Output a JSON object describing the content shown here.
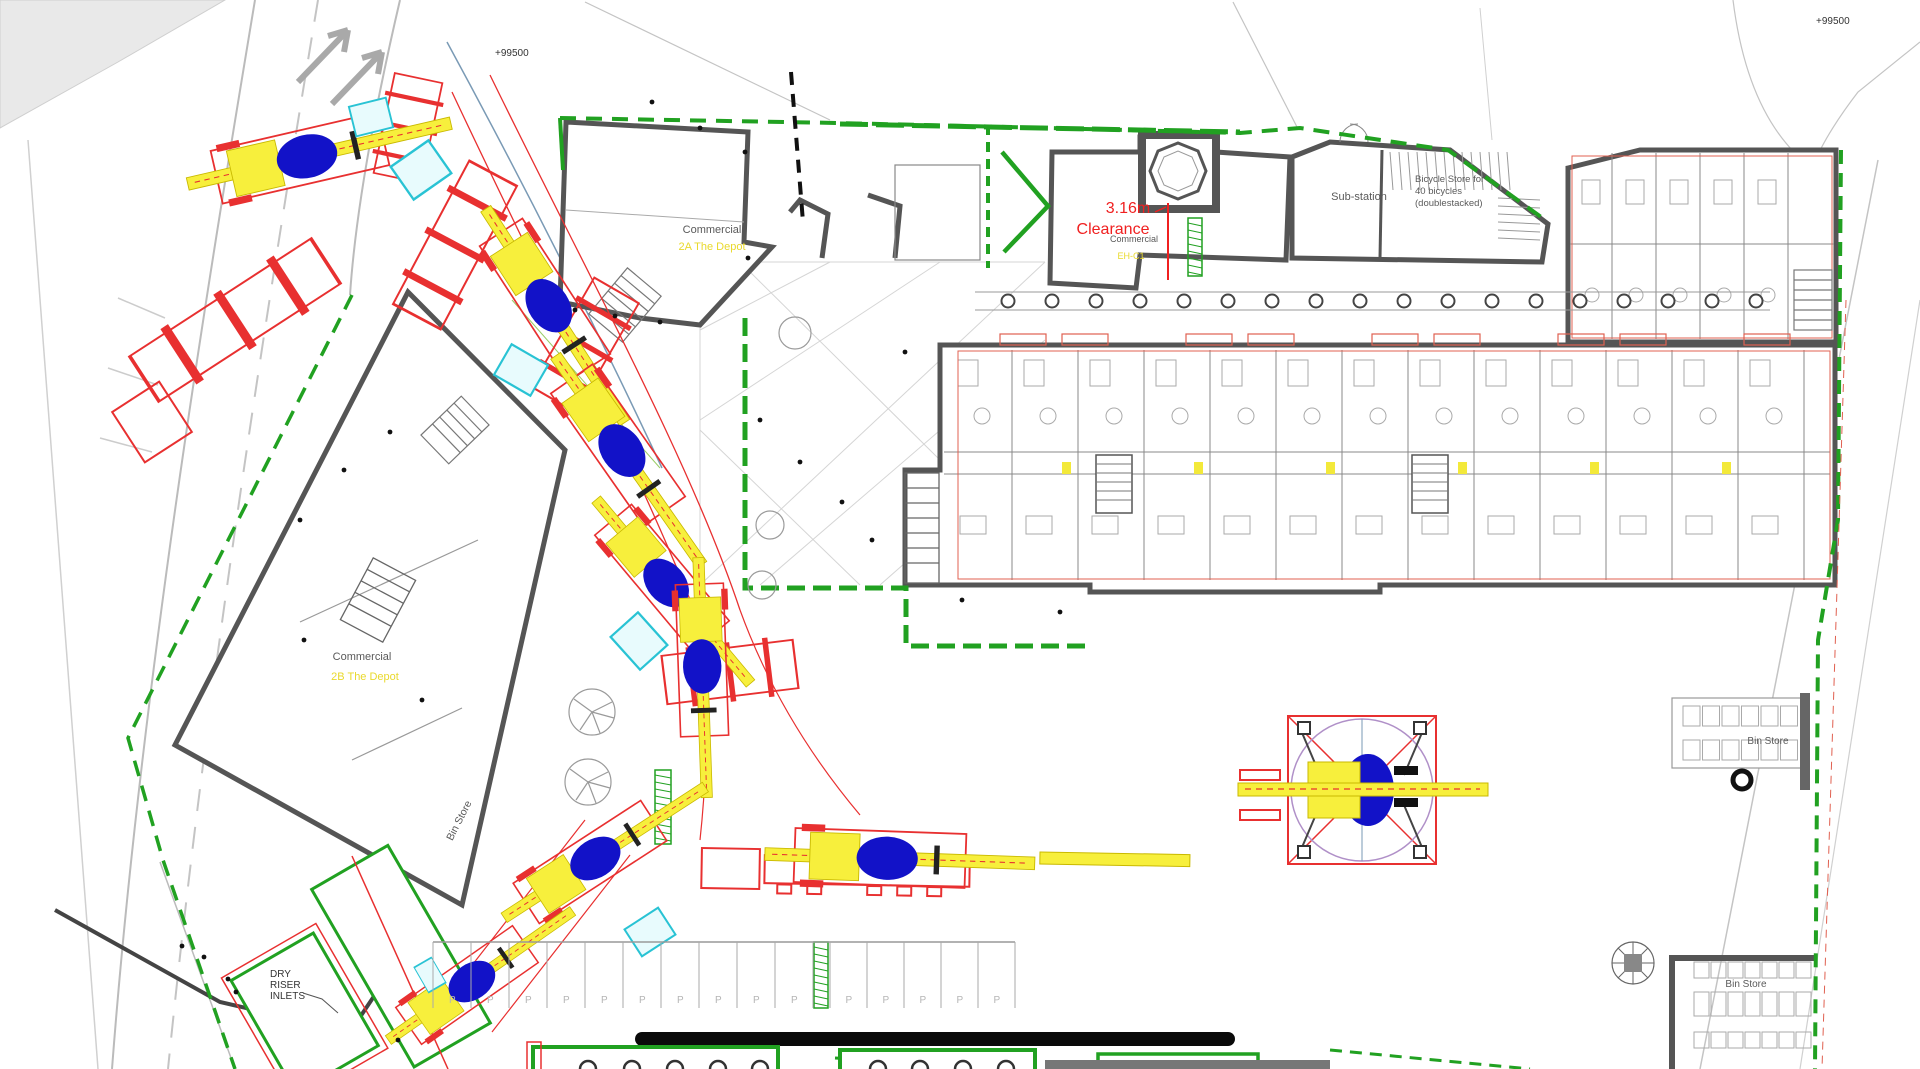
{
  "drawing": {
    "type": "construction-site-logistics-plan",
    "datum_top_left": "+99500",
    "datum_top_right": "+99500"
  },
  "labels": {
    "commercial_2a": {
      "title": "Commercial",
      "subtitle": "2A The Depot"
    },
    "commercial_2b": {
      "title": "Commercial",
      "subtitle": "2B The Depot"
    },
    "commercial_eh": {
      "title": "Commercial",
      "subtitle": "EH-C1"
    },
    "clearance": {
      "line1": "3.16m",
      "line2": "Clearance"
    },
    "substation": "Sub-station",
    "bicycle_store": {
      "line1": "Bicycle Store for",
      "line2": "40 bicycles",
      "line3": "(doublestacked)"
    },
    "bin_store_left": "Bin Store",
    "bin_store_right_upper": "Bin Store",
    "bin_store_right_lower": "Bin Store",
    "dry_riser": {
      "line1": "DRY",
      "line2": "RISER",
      "line3": "INLETS"
    }
  },
  "parking": {
    "stall_label": "P",
    "left_count": 10,
    "right_count": 5
  },
  "colors": {
    "site_boundary_green": "#21a121",
    "crane_boom_yellow": "#f7ef3c",
    "crane_cab_blue": "#1212c8",
    "swept_path_red": "#e83030",
    "spreader_pad_cyan": "#29c3d4",
    "wall_gray": "#555555",
    "clearance_red": "#f02020",
    "unit_label_yellow": "#e9d92c",
    "road_gray": "#bbbbbb"
  }
}
